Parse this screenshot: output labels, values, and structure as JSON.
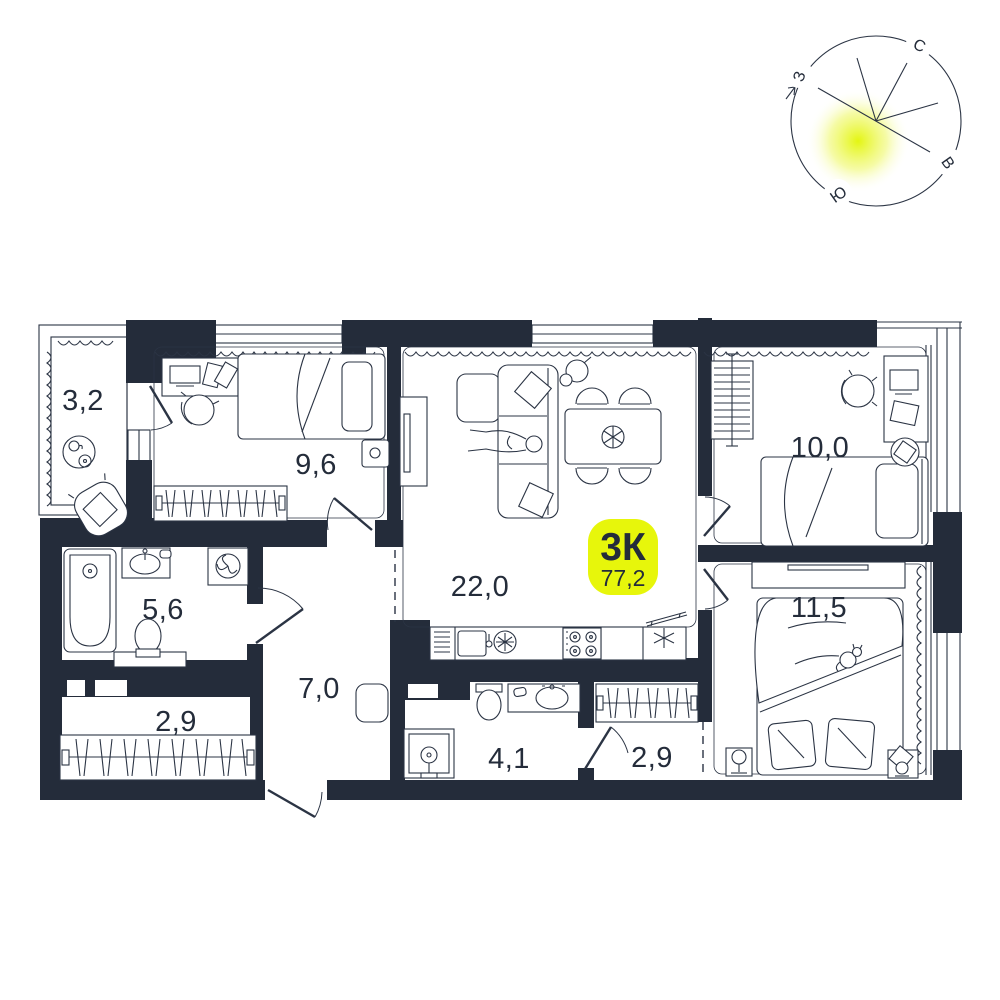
{
  "badge": {
    "type": "3К",
    "area": "77,2"
  },
  "rooms": {
    "balcony": "3,2",
    "bedroom_small": "9,6",
    "living_kitchen": "22,0",
    "bedroom_mid": "10,0",
    "bedroom_master": "11,5",
    "bathroom": "5,6",
    "hallway": "7,0",
    "wardrobe_left": "2,9",
    "bathroom_guest": "4,1",
    "wardrobe_right": "2,9"
  },
  "compass": {
    "north": "С",
    "east": "В",
    "south": "Ю",
    "west": "З"
  },
  "colors": {
    "walls": "#242c3a",
    "lines": "#2b3444",
    "accent_yellow": "#e7f60b",
    "sun_glow": "#e2f505"
  }
}
